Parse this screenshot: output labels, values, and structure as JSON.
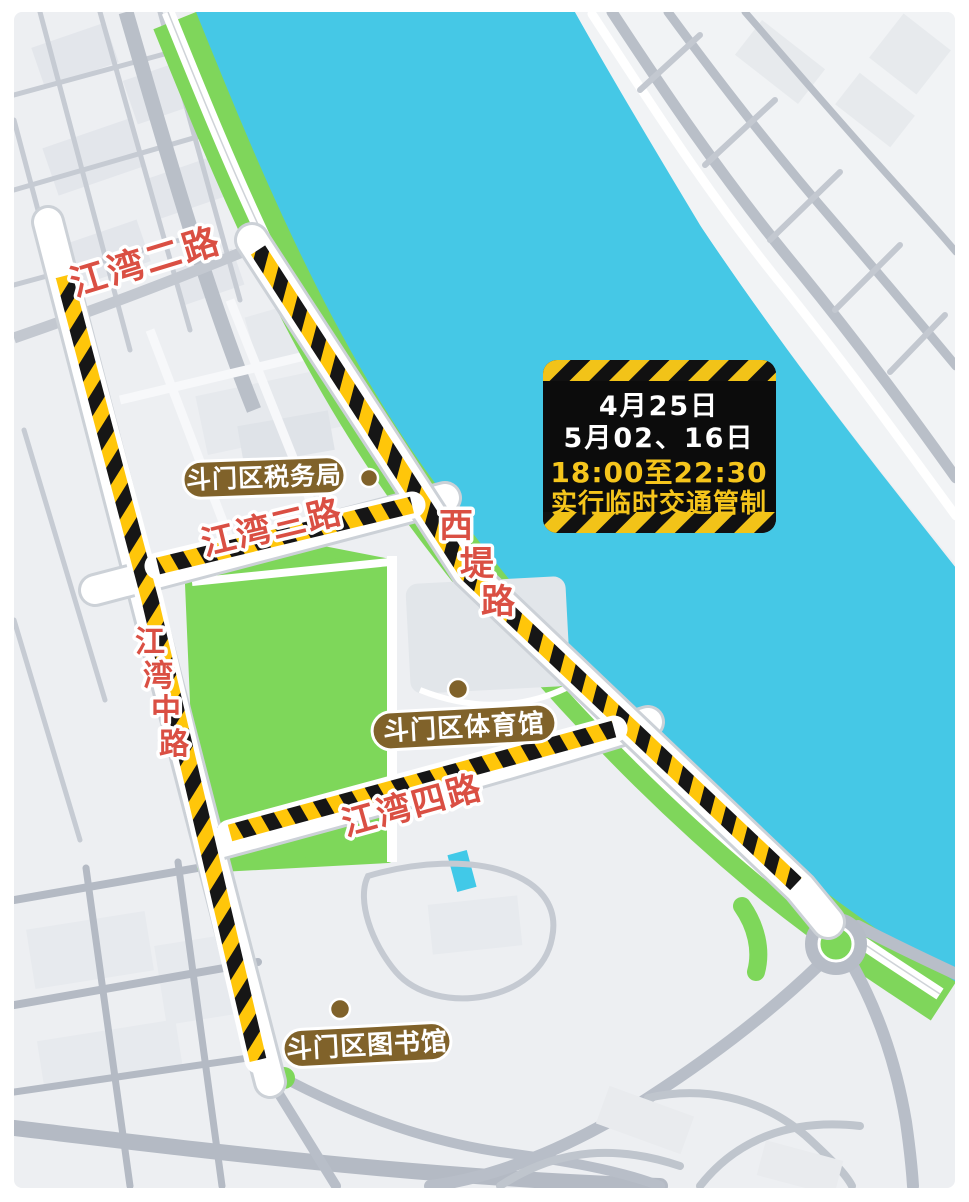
{
  "notice": {
    "line1": "4月25日",
    "line2": "5月02、16日",
    "line3": "18:00至22:30",
    "line4": "实行临时交通管制"
  },
  "roads": {
    "jiangwan_er": "江湾二路",
    "jiangwan_san": "江湾三路",
    "jiangwan_si": "江湾四路",
    "jiangwan_zhong": {
      "chars": [
        "江",
        "湾",
        "中",
        "路"
      ]
    },
    "xidi": {
      "chars": [
        "西",
        "堤",
        "路"
      ]
    }
  },
  "pois": {
    "tax_bureau": "斗门区税务局",
    "stadium": "斗门区体育馆",
    "library": "斗门区图书馆"
  },
  "colors": {
    "river": "#45C8E6",
    "park_green": "#7ED75A",
    "hazard_yellow": "#FFC60A",
    "hazard_black": "#161616",
    "road_label_red": "#DA4F43",
    "poi_brown": "#80622A",
    "notice_bg": "#0C0C0C",
    "notice_highlight": "#F5C51C"
  }
}
